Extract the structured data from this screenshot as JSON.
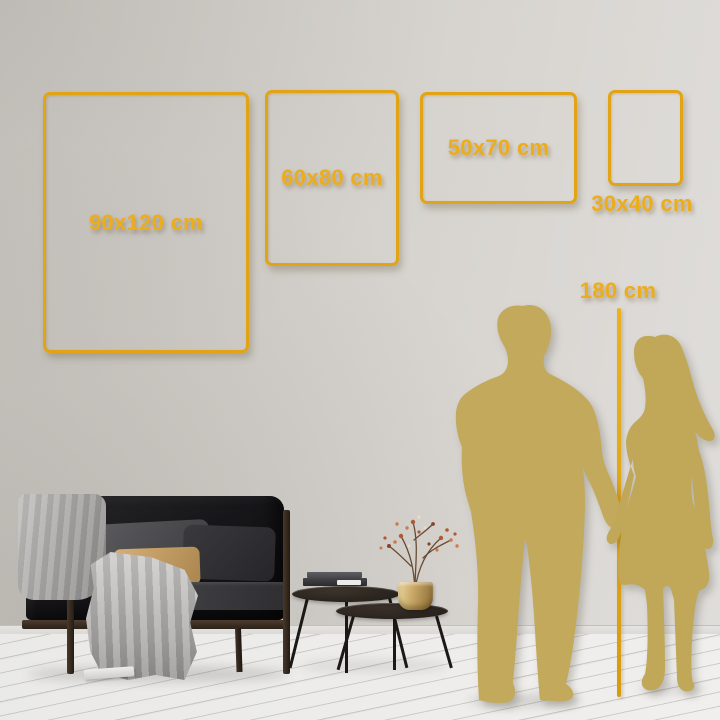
{
  "size_guide": {
    "frames": [
      {
        "label": "90x120 cm",
        "width_cm": 90,
        "height_cm": 120
      },
      {
        "label": "60x80 cm",
        "width_cm": 60,
        "height_cm": 80
      },
      {
        "label": "50x70 cm",
        "width_cm": 50,
        "height_cm": 70
      },
      {
        "label": "30x40 cm",
        "width_cm": 30,
        "height_cm": 40
      }
    ],
    "height_reference": {
      "label": "180 cm",
      "height_cm": 180
    }
  },
  "colors": {
    "frame_gold": "#E2A414",
    "label_gold": "#EDAD1B",
    "silhouette_gold": "#C3A95B",
    "wall": "#D5D2CE",
    "floor": "#F2F1EF"
  },
  "scene_objects": [
    "sofa",
    "gray-blanket",
    "pillows",
    "nesting-coffee-tables",
    "books",
    "brass-vase",
    "dried-branch",
    "floor-paper",
    "man-silhouette",
    "woman-silhouette",
    "height-ruler"
  ]
}
